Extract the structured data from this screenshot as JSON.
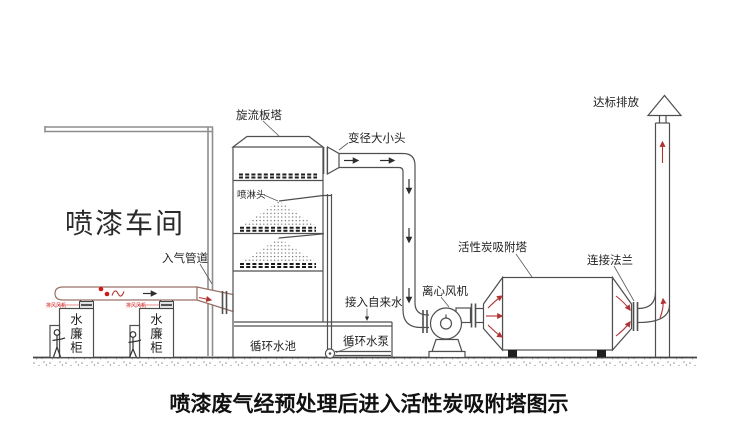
{
  "caption": "喷漆废气经预处理后进入活性炭吸附塔图示",
  "workshop": {
    "name": "喷漆车间",
    "inlet_duct_label": "入气管道",
    "cabinet_label_chars": [
      "水",
      "廉",
      "柜"
    ],
    "cabinet_fan_label": "排风风机"
  },
  "scrubber": {
    "tower_label": "旋流板塔",
    "spray_head_label": "喷淋头",
    "reducer_label": "变径大小头",
    "pool_label": "循环水池",
    "pump_label": "循环水泵",
    "tap_water_label": "接入自来水"
  },
  "adsorber": {
    "fan_label": "离心风机",
    "tower_label": "活性炭吸附塔",
    "flange_label": "连接法兰",
    "discharge_label": "达标排放"
  },
  "colors": {
    "line": "#4f4f4f",
    "wall_gray": "#8e8e8e",
    "duct_brown": "#9a7168",
    "accent_red": "#b03434",
    "bright_red": "#d01818",
    "text": "#1f1f1f"
  }
}
